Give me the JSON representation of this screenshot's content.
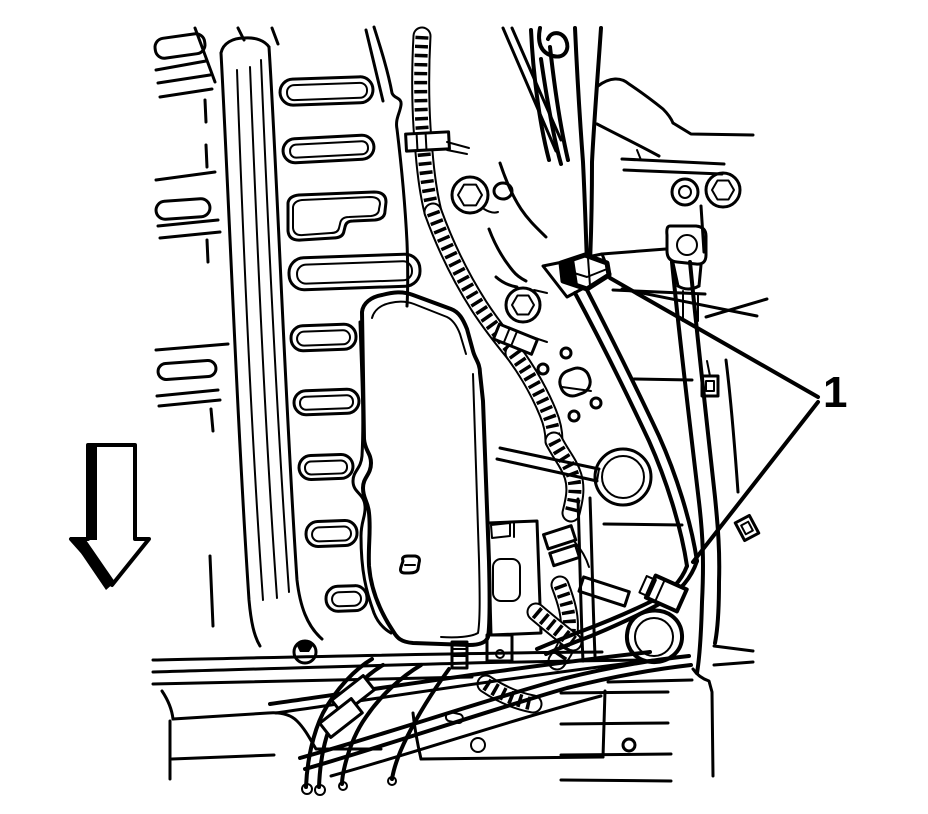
{
  "figure": {
    "background_color": "#ffffff",
    "line_color": "#000000",
    "callout_1": {
      "label": "1"
    },
    "arrow": {
      "direction": "down"
    }
  }
}
